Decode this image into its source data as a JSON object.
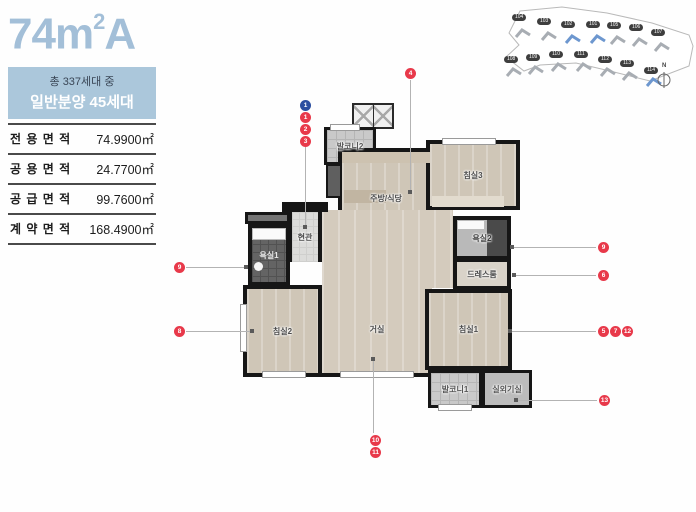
{
  "header": {
    "title": {
      "base": "74m",
      "sup": "2",
      "variant": "A"
    },
    "unit_badge": {
      "line1": "총 337세대 중",
      "line2": "일반분양 45세대"
    }
  },
  "area_table": {
    "rows": [
      {
        "label": "전 용 면 적",
        "value": "74.9900㎡"
      },
      {
        "label": "공 용 면 적",
        "value": "24.7700㎡"
      },
      {
        "label": "공 급 면 적",
        "value": "99.7600㎡"
      },
      {
        "label": "계 약 면 적",
        "value": "168.4900㎡"
      }
    ]
  },
  "plan": {
    "rooms": {
      "balcony2": {
        "label": "발코니2"
      },
      "kitchen": {
        "label": "주방/식당"
      },
      "bedroom3": {
        "label": "침실3"
      },
      "entrance": {
        "label": "현관"
      },
      "bath1": {
        "label": "욕실1"
      },
      "bath2": {
        "label": "욕실2"
      },
      "dressroom": {
        "label": "드레스룸"
      },
      "bedroom2": {
        "label": "침실2"
      },
      "living": {
        "label": "거실"
      },
      "bedroom1": {
        "label": "침실1"
      },
      "balcony1": {
        "label": "발코니1"
      },
      "acroom": {
        "label": "실외기실"
      }
    }
  },
  "callouts": {
    "b1": "1",
    "n1": "1",
    "n2": "2",
    "n3": "3",
    "n4": "4",
    "n9l": "9",
    "n8l": "8",
    "n9r": "9",
    "n6r": "6",
    "n5": "5",
    "n7": "7",
    "n12": "12",
    "n13": "13",
    "n10": "10",
    "n11": "11"
  },
  "site_plan": {
    "north": "N",
    "buildings": [
      {
        "label": "104",
        "highlighted": false
      },
      {
        "label": "103",
        "highlighted": false
      },
      {
        "label": "102",
        "highlighted": true
      },
      {
        "label": "101",
        "highlighted": true
      },
      {
        "label": "105",
        "highlighted": false
      },
      {
        "label": "106",
        "highlighted": false
      },
      {
        "label": "107",
        "highlighted": false
      },
      {
        "label": "108",
        "highlighted": false
      },
      {
        "label": "109",
        "highlighted": false
      },
      {
        "label": "110",
        "highlighted": false
      },
      {
        "label": "111",
        "highlighted": false
      },
      {
        "label": "112",
        "highlighted": false
      },
      {
        "label": "113",
        "highlighted": false
      },
      {
        "label": "114",
        "highlighted": true
      }
    ]
  },
  "colors": {
    "title_blue": "#a3bfd8",
    "badge_bg": "#abc7db",
    "callout_red": "#e8394a",
    "callout_blue": "#2b4fa0",
    "wall": "#161616"
  }
}
